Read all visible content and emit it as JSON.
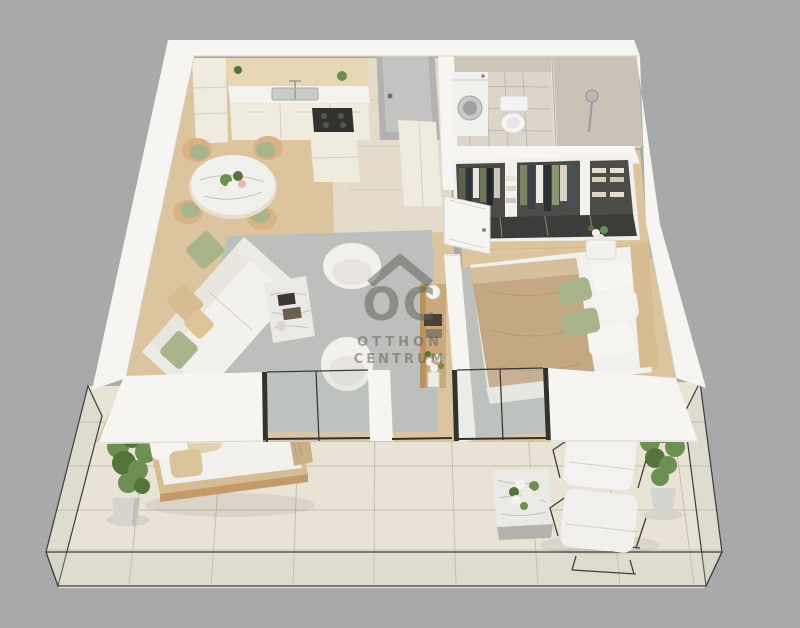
{
  "watermark": {
    "logo_text": "OC",
    "line1": "OTTHON",
    "line2": "CENTRUM",
    "logo_icon": "house-roof-icon"
  },
  "palette": {
    "bg": "#a9a9a9",
    "wall": "#f6f5f2",
    "wall-shade": "#e9e6e0",
    "wood": "#dcc49f",
    "wood-light": "#e6dfd1",
    "tile-terrace": "#e8e3d5",
    "rug": "#bcbfbb",
    "sofa": "#f3f1ee",
    "sage": "#a9b48c",
    "tan": "#d7bb92",
    "duvet": "#c4a884",
    "marble": "#eae9e6",
    "cabinet": "#f0ebdf",
    "backsplash": "#e5d7b6",
    "bath-tile": "#cdc5b8",
    "bath-floor": "#dcd5c9",
    "door-gray": "#b3b2b0",
    "metal": "#33322f",
    "plant": "#6d8f52",
    "plant-dark": "#54743c",
    "watermark": "rgba(95,93,90,0.52)"
  }
}
